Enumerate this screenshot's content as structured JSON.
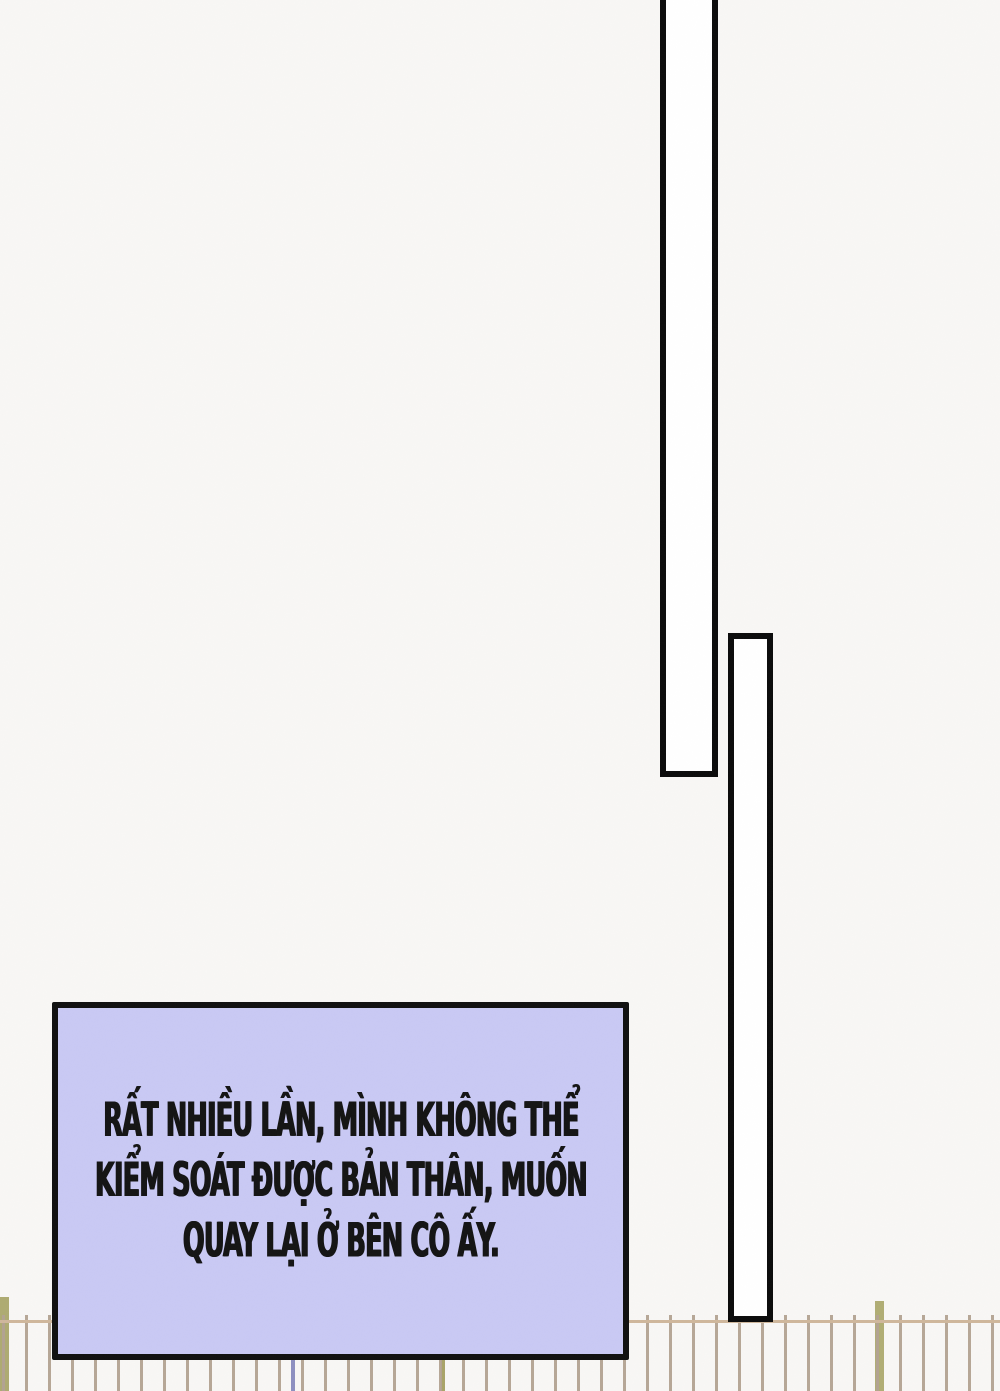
{
  "panel": {
    "type": "comic-page-panel",
    "narration": {
      "lines": [
        "RẤT NHIỀU LẦN, MÌNH KHÔNG THỂ",
        "KIỂM SOÁT ĐƯỢC BẢN THÂN, MUỐN",
        "QUAY LẠI Ở BÊN CÔ ẤY."
      ]
    }
  },
  "colors": {
    "background": "#f8f7f5",
    "narration_box_fill": "#c9c9f4",
    "narration_box_border": "#101010",
    "narration_text": "#141414",
    "panel_bar_fill": "#ffffff",
    "panel_bar_border": "#0b0b0b",
    "fence_rail": "#cfb79c",
    "fence_post": "#b2a292",
    "fence_post_olive": "#aeab72",
    "fence_post_blue": "#8d8fc0"
  }
}
